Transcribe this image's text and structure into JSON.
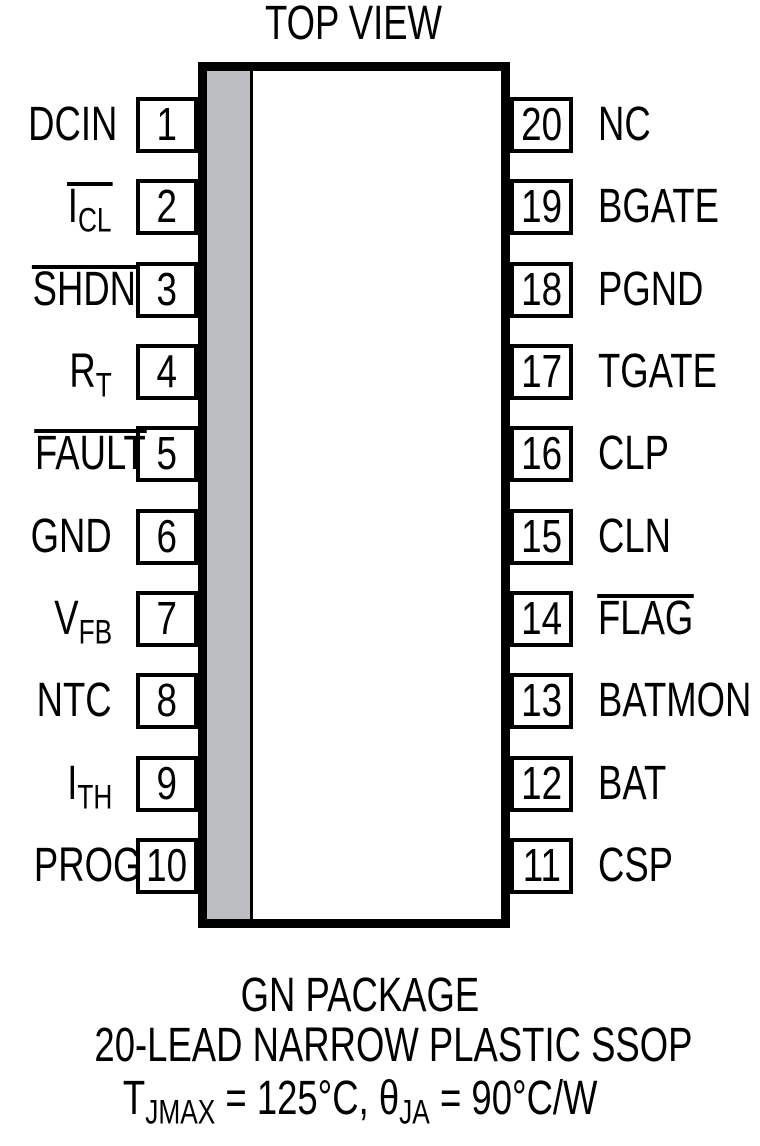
{
  "title": "TOP VIEW",
  "package": {
    "left_pins": [
      {
        "number": "1",
        "base": "DCIN",
        "sub": "",
        "overline": false
      },
      {
        "number": "2",
        "base": "I",
        "sub": "CL",
        "overline": true
      },
      {
        "number": "3",
        "base": "SHDN",
        "sub": "",
        "overline": true
      },
      {
        "number": "4",
        "base": "R",
        "sub": "T",
        "overline": false
      },
      {
        "number": "5",
        "base": "FAULT",
        "sub": "",
        "overline": true
      },
      {
        "number": "6",
        "base": "GND",
        "sub": "",
        "overline": false
      },
      {
        "number": "7",
        "base": "V",
        "sub": "FB",
        "overline": false
      },
      {
        "number": "8",
        "base": "NTC",
        "sub": "",
        "overline": false
      },
      {
        "number": "9",
        "base": "I",
        "sub": "TH",
        "overline": false
      },
      {
        "number": "10",
        "base": "PROG",
        "sub": "",
        "overline": false
      }
    ],
    "right_pins": [
      {
        "number": "20",
        "base": "NC",
        "sub": "",
        "overline": false
      },
      {
        "number": "19",
        "base": "BGATE",
        "sub": "",
        "overline": false
      },
      {
        "number": "18",
        "base": "PGND",
        "sub": "",
        "overline": false
      },
      {
        "number": "17",
        "base": "TGATE",
        "sub": "",
        "overline": false
      },
      {
        "number": "16",
        "base": "CLP",
        "sub": "",
        "overline": false
      },
      {
        "number": "15",
        "base": "CLN",
        "sub": "",
        "overline": false
      },
      {
        "number": "14",
        "base": "FLAG",
        "sub": "",
        "overline": true
      },
      {
        "number": "13",
        "base": "BATMON",
        "sub": "",
        "overline": false
      },
      {
        "number": "12",
        "base": "BAT",
        "sub": "",
        "overline": false
      },
      {
        "number": "11",
        "base": "CSP",
        "sub": "",
        "overline": false
      }
    ]
  },
  "captions": {
    "line1": "GN PACKAGE",
    "line2": "20-LEAD NARROW PLASTIC SSOP",
    "line3": {
      "t1": "T",
      "s1": "JMAX",
      "t2": " = 125°C, θ",
      "s2": "JA",
      "t3": " = 90°C/W"
    }
  },
  "colors": {
    "ink": "#000000",
    "pin1_stripe": "#bcbec1",
    "background": "#ffffff"
  }
}
